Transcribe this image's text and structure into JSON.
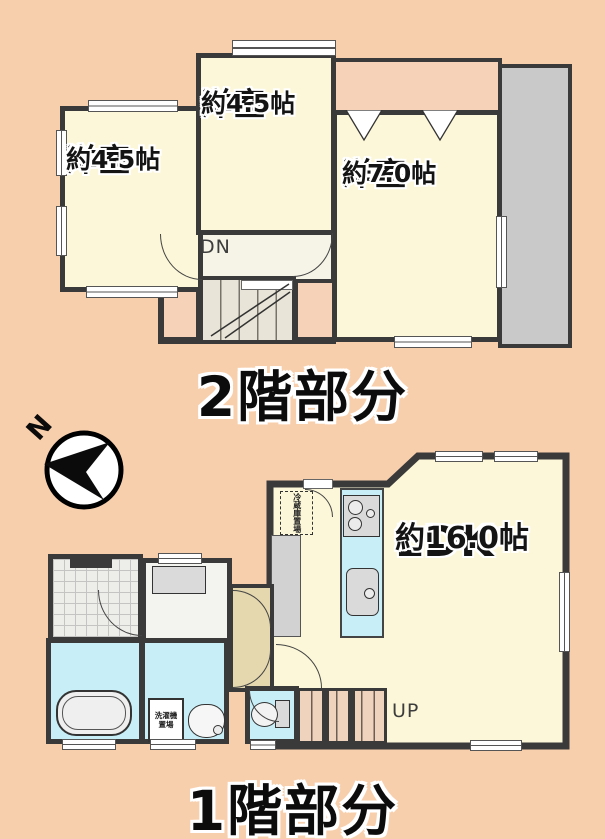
{
  "colors": {
    "bg": "#F8CFAC",
    "wall": "#3A3A3A",
    "room": "#FCF7D8",
    "wet": "#C8EFF7",
    "gray": "#C9C9C9",
    "tan": "#E5D8AE",
    "peach2": "#F6D3B8",
    "stair1": "#F0D3BD",
    "stair2": "#E8E5D8"
  },
  "compass": {
    "north_label": "N"
  },
  "floor2": {
    "caption": "2階部分",
    "stairs_label": "DN",
    "rooms": [
      {
        "name": "洋室",
        "size": "約4.5帖"
      },
      {
        "name": "洋室",
        "size": "約4.5帖"
      },
      {
        "name": "洋室",
        "size": "約7.0帖"
      }
    ]
  },
  "floor1": {
    "caption": "1階部分",
    "stairs_label": "UP",
    "rooms": [
      {
        "name": "LDK",
        "size": "約16.0帖"
      }
    ],
    "fridge_label": "冷蔵庫置場",
    "washer_label_line1": "洗濯機",
    "washer_label_line2": "置場"
  }
}
